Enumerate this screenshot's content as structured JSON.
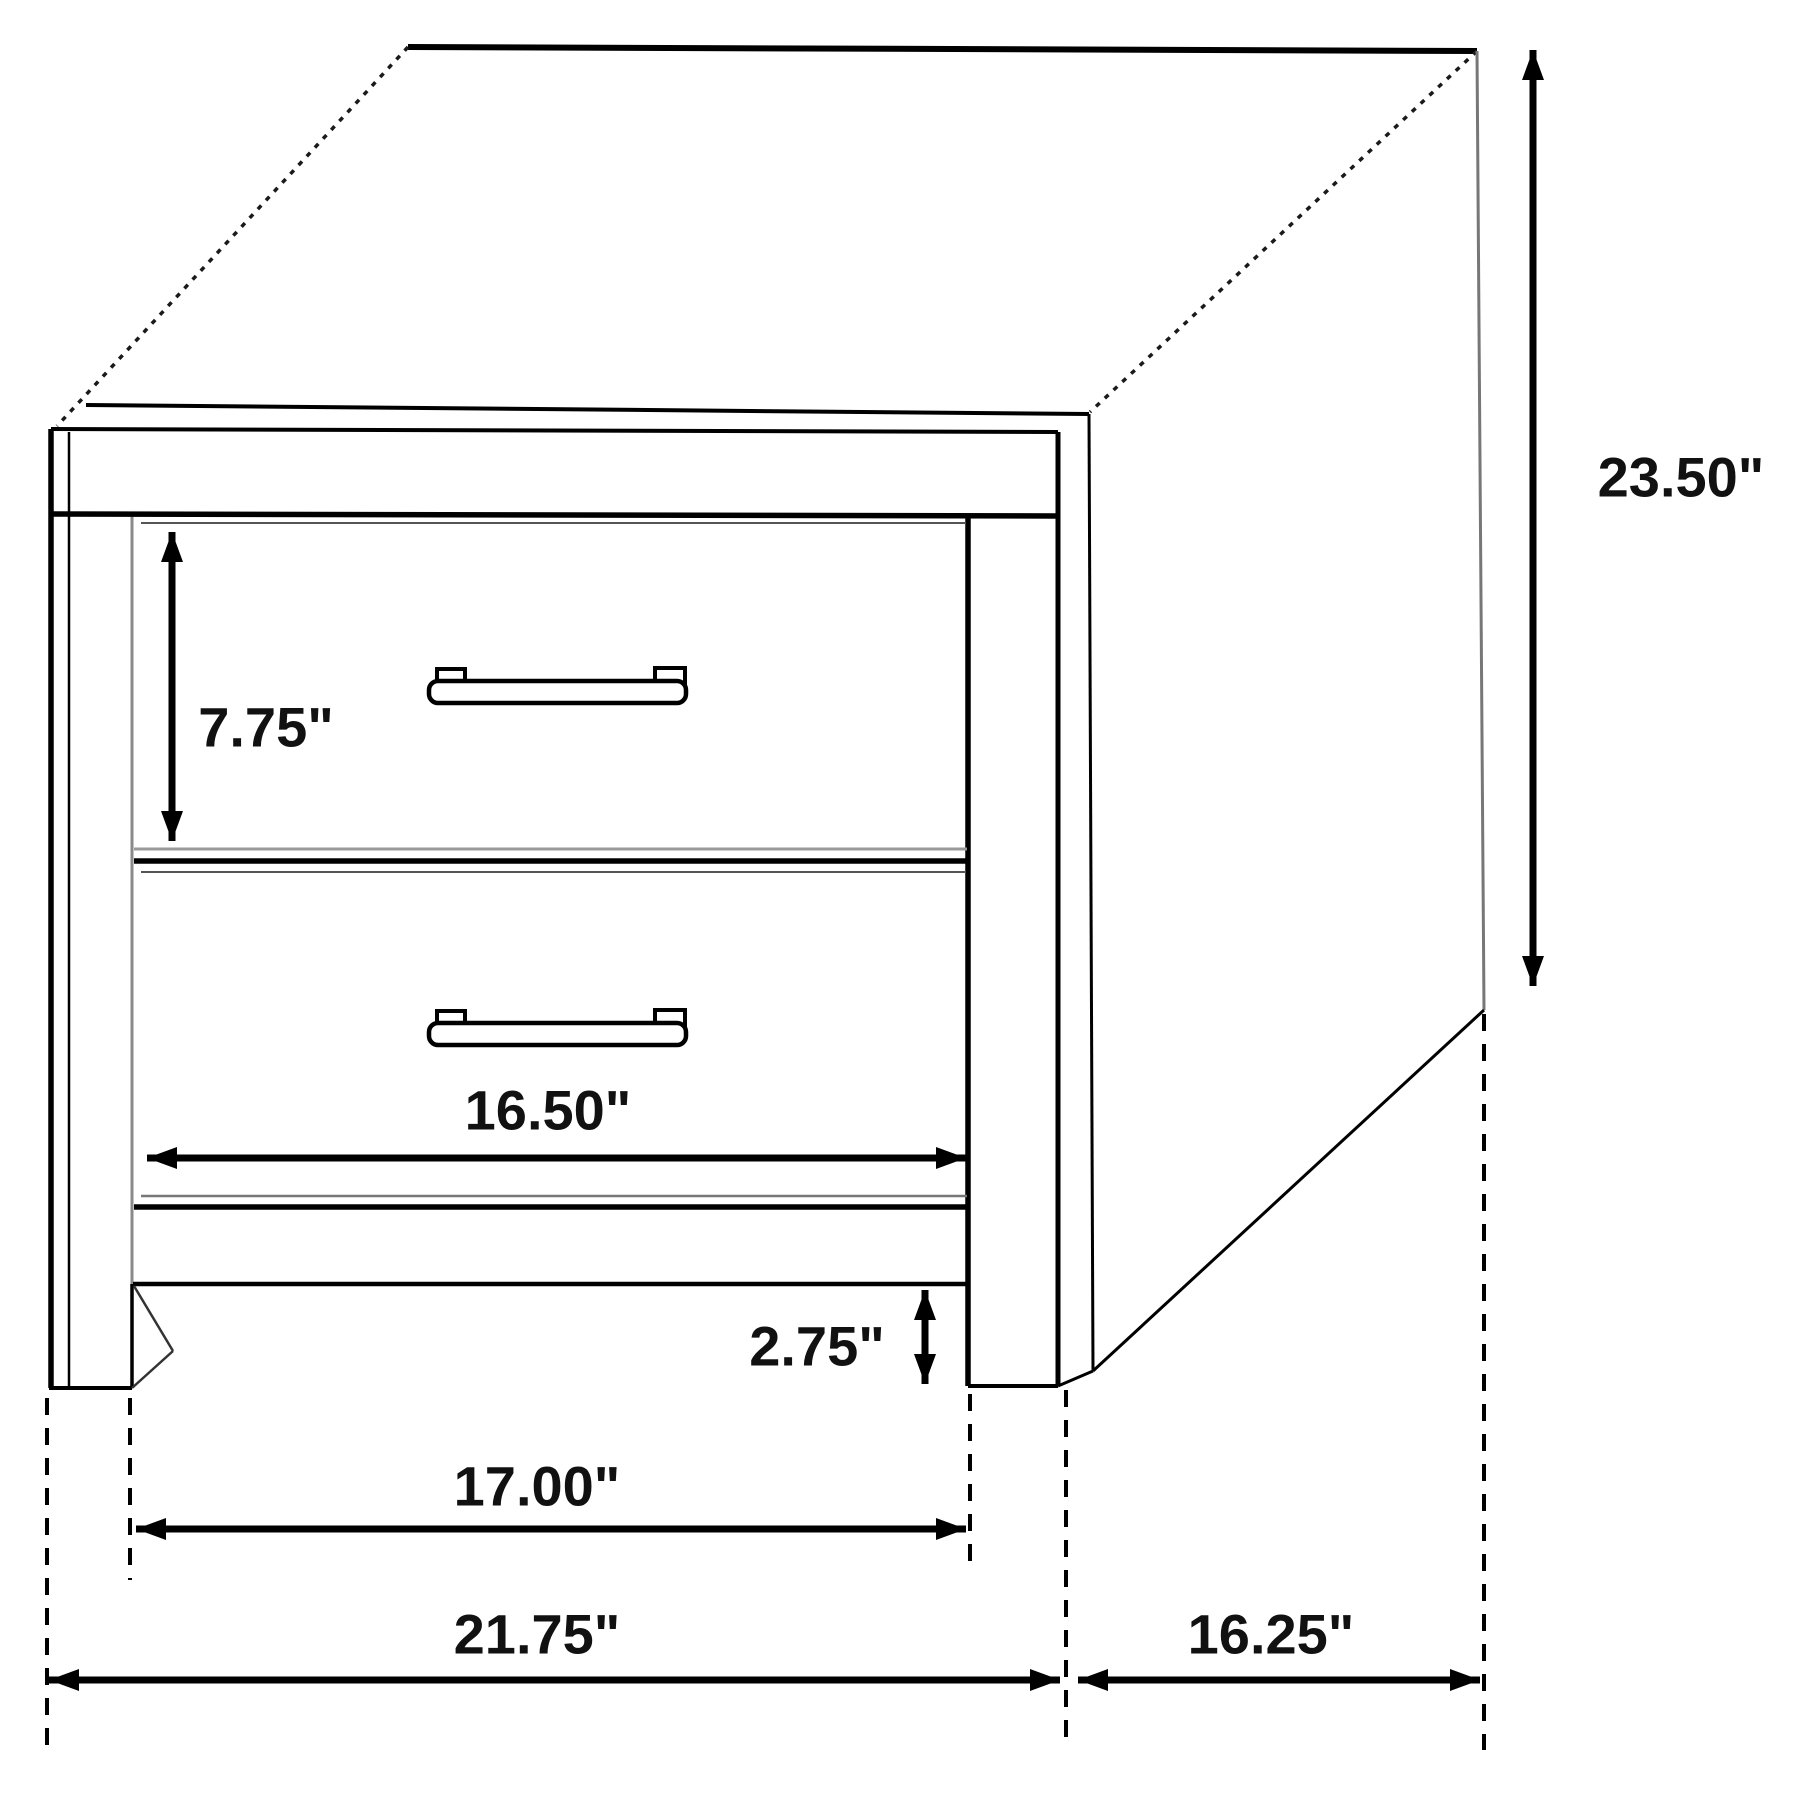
{
  "diagram": {
    "subject": "two-drawer nightstand line drawing with dimension annotations",
    "unit": "inches"
  },
  "dimensions": {
    "overall_height": {
      "value": 23.5,
      "label": "23.50\""
    },
    "top_drawer_height": {
      "value": 7.75,
      "label": "7.75\""
    },
    "drawer_width": {
      "value": 16.5,
      "label": "16.50\""
    },
    "leg_height": {
      "value": 2.75,
      "label": "2.75\""
    },
    "base_width": {
      "value": 17.0,
      "label": "17.00\""
    },
    "overall_width": {
      "value": 21.75,
      "label": "21.75\""
    },
    "overall_depth": {
      "value": 16.25,
      "label": "16.25\""
    }
  },
  "colors": {
    "background": "#ffffff",
    "line": "#000000",
    "secondary_line": "#8a8a8a",
    "label_text": "#111111"
  }
}
